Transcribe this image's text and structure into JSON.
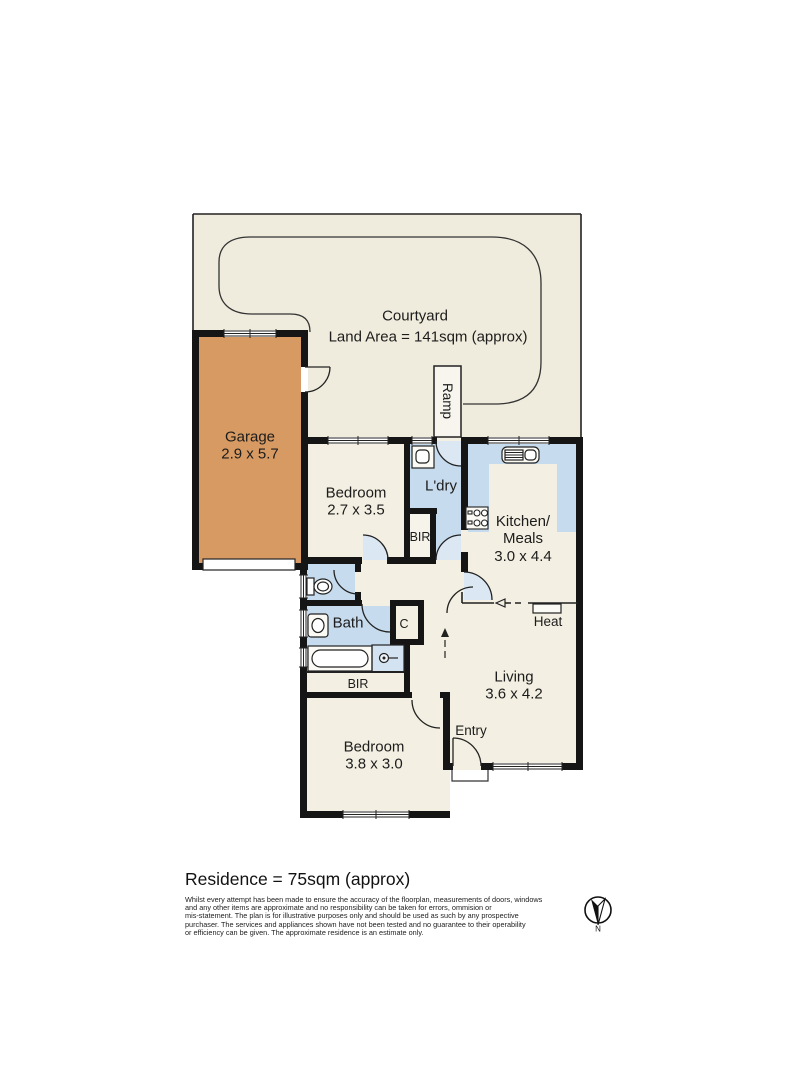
{
  "plan": {
    "courtyard": {
      "title": "Courtyard",
      "land_area": "Land Area = 141sqm (approx)"
    },
    "rooms": {
      "garage": {
        "label": "Garage",
        "dims": "2.9 x 5.7"
      },
      "bedroom1": {
        "label": "Bedroom",
        "dims": "2.7 x 3.5"
      },
      "laundry": {
        "label": "L'dry"
      },
      "bir1": {
        "label": "BIR"
      },
      "kitchen": {
        "label": "Kitchen/",
        "label2": "Meals",
        "dims": "3.0 x 4.4"
      },
      "bath": {
        "label": "Bath"
      },
      "closet": {
        "label": "C"
      },
      "heat": {
        "label": "Heat"
      },
      "living": {
        "label": "Living",
        "dims": "3.6 x 4.2"
      },
      "bir2": {
        "label": "BIR"
      },
      "entry": {
        "label": "Entry"
      },
      "bedroom2": {
        "label": "Bedroom",
        "dims": "3.8 x 3.0"
      },
      "ramp": {
        "label": "Ramp"
      }
    },
    "compass": {
      "label": "N"
    }
  },
  "footer": {
    "residence": "Residence = 75sqm (approx)",
    "disclaimer_lines": [
      "Whilst every attempt has been made to ensure the accuracy of the floorplan, measurements of doors, windows",
      "and any other items are approximate and no responsibility can be taken for errors, ommision or",
      "mis-statement. The plan is for illustrative purposes only and should be used as such by any prospective",
      "purchaser. The services and appliances shown have not been tested and no guarantee to their operability",
      "or efficiency can be given. The approximate residence is an estimate only."
    ]
  },
  "colors": {
    "room_cream": "#f3efe2",
    "courtyard_beige": "#f0ecdd",
    "garage_orange": "#d69a62",
    "wet_area_blue": "#c6dbed",
    "door_swing_blue": "#dbe8f4",
    "wall_black": "#151515"
  }
}
